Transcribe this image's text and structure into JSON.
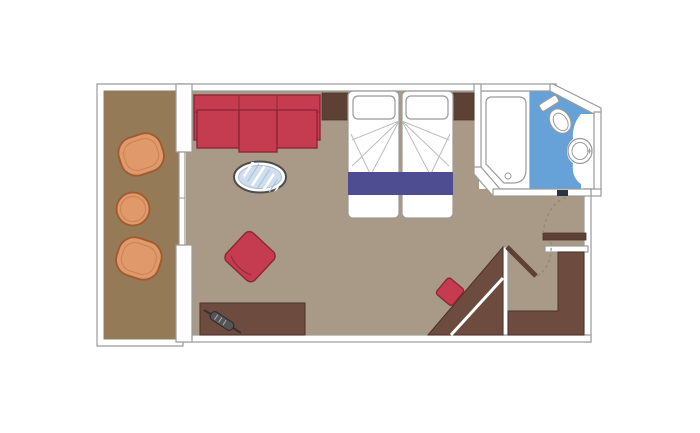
{
  "plan": {
    "kind": "cruise-cabin-floor-plan",
    "rooms": [
      "balcony",
      "bedroom-living-area",
      "bathroom",
      "entry-area"
    ],
    "balcony": {
      "furniture": [
        "deck-chair",
        "round-table",
        "deck-chair"
      ]
    },
    "bedroom": {
      "furniture": [
        "three-seat-sofa",
        "side-table-left",
        "double-bed-two-mattresses",
        "bed-runner",
        "side-table-right",
        "oval-rug",
        "armchair",
        "vanity-desk",
        "hairdryer"
      ]
    },
    "bathroom": {
      "fixtures": [
        "bathtub",
        "toilet",
        "washbasin"
      ],
      "floor": "blue"
    },
    "entry": {
      "furniture": [
        "corner-wardrobe",
        "wardrobe-unit-l-shaped",
        "stool"
      ],
      "doors": [
        "entry-door-leaf",
        "door-swing-arcs",
        "sliding-balcony-door",
        "bathroom-door-threshold"
      ]
    }
  },
  "colors": {
    "background": "#ffffff",
    "wall_fill": "#ffffff",
    "wall_line": "#9a9a9a",
    "room_floor": "#a89a87",
    "balcony_floor": "#957a58",
    "wood": "#6d4b3f",
    "wood_dark": "#5d4134",
    "wood_line": "#4a332a",
    "red": "#c53b50",
    "red_dark": "#8e2737",
    "orange": "#e0996b",
    "orange_dark": "#a15a2c",
    "orange_inner": "#c8834f",
    "bath_blue": "#66a2d8",
    "runner_purple": "#4f4d92",
    "rug_blue": "#cfdeee",
    "rug_line": "#a9bdd6",
    "rug_ring": "#4d4d4d",
    "fixture_line": "#9a9a9a",
    "threshold_dark": "#2a3440",
    "door_swing": "#948272"
  }
}
